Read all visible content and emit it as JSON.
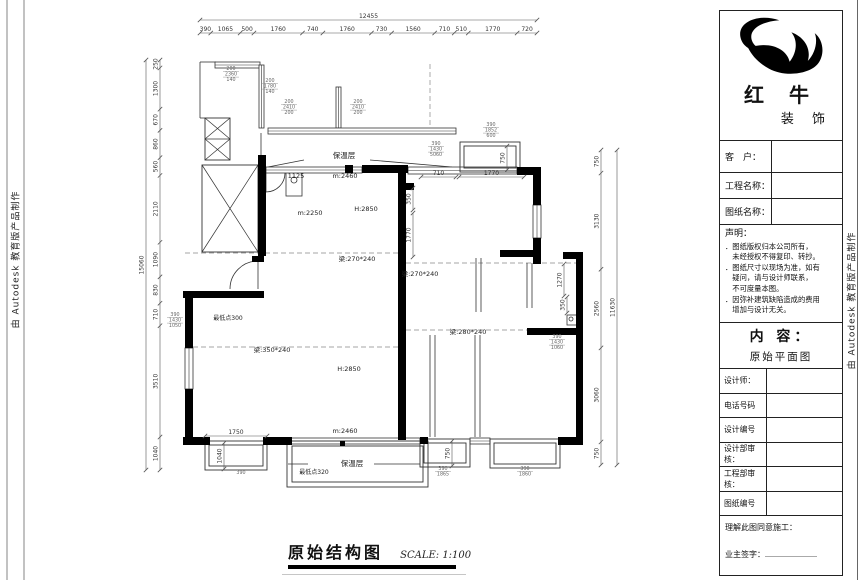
{
  "sheet": {
    "side_text": "由 Autodesk 教育版产品制作"
  },
  "drawing_title": {
    "name": "原始结构图",
    "scale": "SCALE: 1:100"
  },
  "title_block": {
    "brand_line1": "红 牛",
    "brand_line2": "装 饰",
    "fields": {
      "customer": "客　户：",
      "project": "工程名称：",
      "drawing": "图纸名称："
    },
    "statement": {
      "heading": "声明：",
      "lines": [
        "．图纸版权归本公司所有，",
        "　未经授权不得复印、转抄。",
        "．图纸尺寸以现场为准，如有",
        "　疑问，请与设计师联系，",
        "　不可度量本图。",
        "．因弥补建筑缺陷造成的费用",
        "　增加与设计无关。"
      ]
    },
    "content": {
      "heading": "内 容：",
      "value": "原始平面图"
    },
    "rows": [
      {
        "label": "设计师："
      },
      {
        "label": "电话号码"
      },
      {
        "label": "设计编号"
      },
      {
        "label": "设计部审核："
      },
      {
        "label": "工程部审核："
      },
      {
        "label": "图纸编号"
      }
    ],
    "footer": {
      "line1": "理解此图同意施工：",
      "line2": "业主签字："
    }
  },
  "plan": {
    "walls": [
      [
        258,
        155,
        8,
        101
      ],
      [
        183,
        291,
        81,
        7
      ],
      [
        185,
        298,
        8,
        50
      ],
      [
        185,
        389,
        8,
        50
      ],
      [
        183,
        437,
        27,
        8
      ],
      [
        263,
        437,
        29,
        8
      ],
      [
        345,
        165,
        8,
        8
      ],
      [
        362,
        165,
        46,
        8
      ],
      [
        398,
        166,
        8,
        95
      ],
      [
        406,
        183,
        8,
        7
      ],
      [
        398,
        261,
        8,
        179
      ],
      [
        517,
        167,
        24,
        8
      ],
      [
        533,
        167,
        8,
        38
      ],
      [
        533,
        238,
        8,
        26
      ],
      [
        500,
        250,
        41,
        7
      ],
      [
        563,
        252,
        20,
        7
      ],
      [
        576,
        252,
        7,
        193
      ],
      [
        527,
        328,
        50,
        7
      ],
      [
        558,
        437,
        25,
        8
      ],
      [
        420,
        437,
        8,
        7
      ],
      [
        252,
        256,
        12,
        6
      ]
    ],
    "windows": [
      [
        215,
        62,
        45,
        6,
        "h"
      ],
      [
        259,
        65,
        5,
        63,
        "v"
      ],
      [
        336,
        87,
        5,
        41,
        "v"
      ],
      [
        268,
        128,
        188,
        6,
        "h"
      ],
      [
        266,
        167,
        96,
        6,
        "h"
      ],
      [
        408,
        167,
        109,
        7,
        "h"
      ],
      [
        533,
        205,
        8,
        33,
        "v"
      ],
      [
        185,
        348,
        8,
        41,
        "v"
      ],
      [
        291,
        438,
        129,
        6,
        "h"
      ],
      [
        470,
        438,
        20,
        6,
        "h"
      ]
    ],
    "bays": [
      [
        [
          205,
          441,
          62,
          29
        ],
        [
          209,
          445,
          54,
          21
        ]
      ],
      [
        [
          287,
          441,
          141,
          46
        ],
        [
          292,
          446,
          131,
          36
        ]
      ],
      [
        [
          420,
          439,
          50,
          28
        ],
        [
          424,
          443,
          42,
          20
        ]
      ],
      [
        [
          490,
          439,
          70,
          29
        ],
        [
          494,
          443,
          62,
          21
        ]
      ],
      [
        [
          460,
          142,
          60,
          30
        ],
        [
          464,
          146,
          52,
          22
        ]
      ]
    ],
    "thin": [
      [
        200,
        62,
        216,
        62
      ],
      [
        200,
        62,
        200,
        118
      ],
      [
        261,
        133,
        261,
        155
      ],
      [
        200,
        118,
        205,
        118
      ],
      [
        476,
        258,
        476,
        312
      ],
      [
        481,
        258,
        481,
        312
      ],
      [
        527,
        263,
        527,
        308
      ],
      [
        532,
        263,
        532,
        308
      ],
      [
        430,
        335,
        430,
        437
      ],
      [
        435,
        335,
        435,
        437
      ],
      [
        475,
        335,
        475,
        437
      ],
      [
        480,
        335,
        480,
        437
      ],
      [
        304,
        160,
        268,
        167
      ],
      [
        370,
        160,
        452,
        167
      ],
      [
        308,
        464,
        288,
        464
      ],
      [
        374,
        464,
        420,
        464
      ],
      [
        258,
        261,
        258,
        289
      ],
      [
        266,
        173,
        266,
        192
      ]
    ],
    "rects_thin": [
      [
        286,
        170,
        16,
        26
      ],
      [
        567,
        315,
        10,
        10
      ]
    ],
    "dashed": [
      [
        185,
        253,
        398,
        253
      ],
      [
        406,
        263,
        576,
        263
      ],
      [
        406,
        330,
        527,
        330
      ],
      [
        193,
        347,
        398,
        347
      ],
      [
        430,
        64,
        430,
        127
      ]
    ],
    "arcs": [
      "M258,261 A28,28 0 0 0 230,289",
      "M285,173 A19,19 0 0 1 266,192"
    ],
    "circles": [
      [
        294,
        180,
        3
      ],
      [
        571,
        319,
        2
      ]
    ],
    "squares": [
      [
        340,
        441,
        5,
        5
      ]
    ],
    "xboxes": [
      {
        "x": 205,
        "y": 118,
        "w": 25,
        "h": 42,
        "rows": 2
      },
      {
        "x": 202,
        "y": 165,
        "w": 56,
        "h": 87,
        "rows": 1
      }
    ],
    "chains": [
      {
        "o": "h",
        "pos": 20,
        "start": 200,
        "end": 537,
        "vals": [
          1
        ],
        "texts": [
          "12455"
        ]
      },
      {
        "o": "h",
        "pos": 33,
        "start": 200,
        "end": 537,
        "vals": [
          390,
          1065,
          500,
          1760,
          740,
          1760,
          730,
          1560,
          710,
          510,
          1770,
          720
        ],
        "texts": [
          "390",
          "1065",
          "500",
          "1760",
          "740",
          "1760",
          "730",
          "1560",
          "710",
          "510",
          "1770",
          "720"
        ]
      },
      {
        "o": "v",
        "pos": 146,
        "start": 60,
        "end": 470,
        "vals": [
          1
        ],
        "texts": [
          "15060"
        ]
      },
      {
        "o": "v",
        "pos": 160,
        "start": 60,
        "end": 470,
        "vals": [
          250,
          1300,
          670,
          860,
          560,
          2110,
          1090,
          830,
          710,
          3510,
          1040
        ],
        "texts": [
          "250",
          "1300",
          "670",
          "860",
          "560",
          "2110",
          "1090",
          "830",
          "710",
          "3510",
          "1040"
        ]
      },
      {
        "o": "v",
        "pos": 617,
        "start": 150,
        "end": 465,
        "vals": [
          1
        ],
        "texts": [
          "11630"
        ]
      },
      {
        "o": "v",
        "pos": 601,
        "start": 150,
        "end": 465,
        "vals": [
          750,
          3130,
          2560,
          3060,
          750
        ],
        "texts": [
          "750",
          "3130",
          "2560",
          "3060",
          "750"
        ]
      },
      {
        "o": "h",
        "pos": 177,
        "start": 421,
        "end": 456,
        "vals": [
          1
        ],
        "texts": [
          "710"
        ]
      },
      {
        "o": "h",
        "pos": 177,
        "start": 459,
        "end": 524,
        "vals": [
          1
        ],
        "texts": [
          "1770"
        ]
      },
      {
        "o": "h",
        "pos": 436,
        "start": 205,
        "end": 267,
        "vals": [
          1
        ],
        "texts": [
          "1750"
        ]
      },
      {
        "o": "v",
        "pos": 452,
        "start": 441,
        "end": 466,
        "vals": [
          1
        ],
        "texts": [
          "750"
        ]
      },
      {
        "o": "v",
        "pos": 224,
        "start": 443,
        "end": 469,
        "vals": [
          1
        ],
        "texts": [
          "1040"
        ]
      },
      {
        "o": "v",
        "pos": 507,
        "start": 146,
        "end": 170,
        "vals": [
          1
        ],
        "texts": [
          "750"
        ]
      },
      {
        "o": "v",
        "pos": 564,
        "start": 264,
        "end": 296,
        "vals": [
          1
        ],
        "texts": [
          "1270"
        ]
      },
      {
        "o": "v",
        "pos": 567,
        "start": 297,
        "end": 313,
        "vals": [
          1
        ],
        "texts": [
          "350"
        ]
      },
      {
        "o": "v",
        "pos": 413,
        "start": 188,
        "end": 210,
        "vals": [
          1
        ],
        "texts": [
          "350"
        ]
      },
      {
        "o": "v",
        "pos": 413,
        "start": 213,
        "end": 257,
        "vals": [
          1
        ],
        "texts": [
          "1770"
        ]
      }
    ],
    "labels": [
      [
        357,
        261,
        "梁:270*240"
      ],
      [
        420,
        276,
        "梁:270*240"
      ],
      [
        468,
        334,
        "梁:280*240"
      ],
      [
        272,
        352,
        "梁:350*240"
      ],
      [
        310,
        215,
        "m:2250"
      ],
      [
        366,
        211,
        "H:2850"
      ],
      [
        349,
        371,
        "H:2850"
      ],
      [
        345,
        178,
        "m:2460"
      ],
      [
        345,
        433,
        "m:2460"
      ],
      [
        296,
        178,
        "1125"
      ],
      [
        228,
        320,
        "最低点300",
        6
      ],
      [
        314,
        474,
        "最低点320",
        6
      ],
      [
        344,
        158,
        "保温层",
        7.5
      ],
      [
        352,
        466,
        "保温层",
        7.5
      ]
    ],
    "stacked": [
      [
        231,
        70,
        [
          "200",
          "2360",
          "140"
        ]
      ],
      [
        270,
        82,
        [
          "200",
          "1780",
          "140"
        ]
      ],
      [
        289,
        103,
        [
          "200",
          "2410",
          "200"
        ]
      ],
      [
        358,
        103,
        [
          "200",
          "2410",
          "200"
        ]
      ],
      [
        436,
        145,
        [
          "390",
          "1430",
          "5060"
        ]
      ],
      [
        491,
        126,
        [
          "390",
          "1852",
          "600"
        ]
      ],
      [
        557,
        338,
        [
          "390",
          "1430",
          "1060"
        ]
      ],
      [
        175,
        316,
        [
          "390",
          "1430",
          "1050"
        ]
      ],
      [
        443,
        470,
        [
          "390",
          "1865"
        ]
      ],
      [
        525,
        470,
        [
          "390",
          "1860"
        ]
      ],
      [
        241,
        474,
        [
          "390"
        ]
      ]
    ]
  }
}
